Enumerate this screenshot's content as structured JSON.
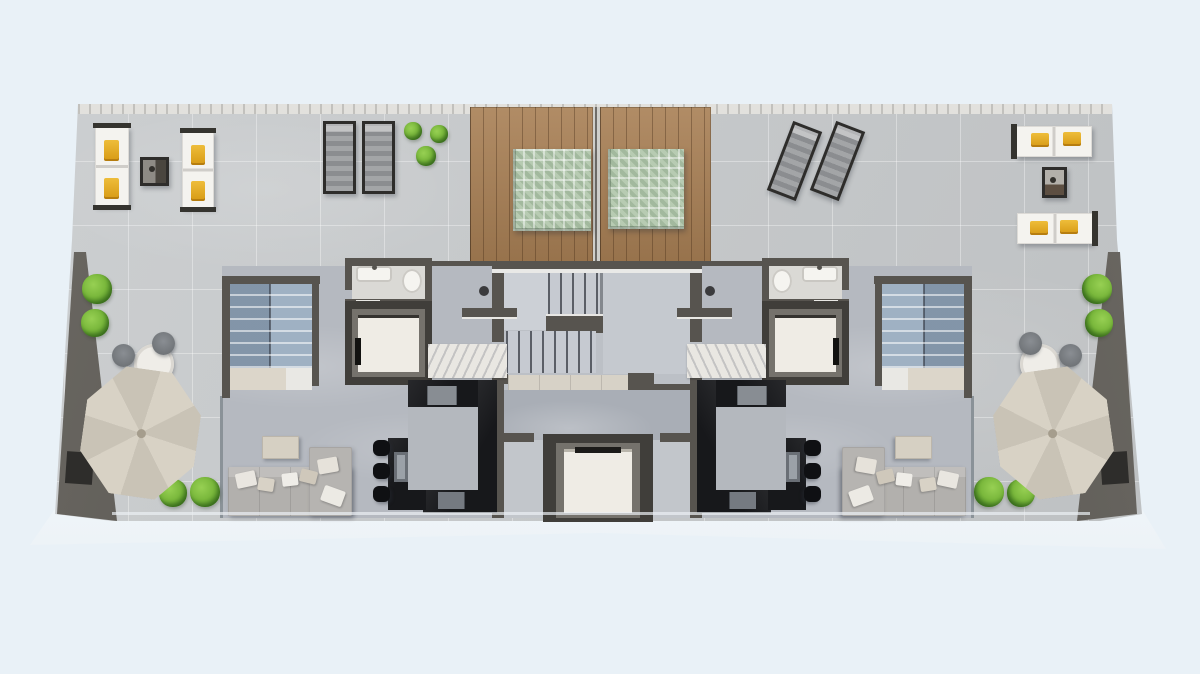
{
  "scene": {
    "type": "architectural-floor-plan",
    "view": "top-down-3d-render",
    "level": "roof-terrace-penthouse-level",
    "units": 2,
    "layout": "two mirrored apartments flanking a central communal stair and elevator core, wrap-around roof terrace"
  },
  "palette": {
    "bg": "#e9f1f7",
    "tile": "#c7cacc",
    "interior": "#b5b9c0",
    "core": "#bcc0c6",
    "hall": "#a9aeb6",
    "wall": "#57544f",
    "wallDark": "#3f3d3a",
    "wallLight": "#716e68",
    "wood": "#a87f54",
    "daybed": "#b7cbb2",
    "stair": "#9fb1c3",
    "landingBeige": "#dcd6ca",
    "kitchen": "#17181b",
    "appliance": "#888d93",
    "stool": "#0f1013",
    "sofa": "#b2b0ad",
    "pillowY": "#e0a41e",
    "pad": "#f4f3ef",
    "frame": "#2e2d2b",
    "slatA": "#a3a5a7",
    "slatB": "#8b8d90",
    "cab": "#efece5",
    "elevFrame": "#75726c",
    "elevSurround": "#403e3a",
    "rug": "#e9e7e2",
    "threshold": "#d7d2c7",
    "glassLine": "#8a9298",
    "parasolA": "#d8d2c5",
    "parasolB": "#c9c3b6",
    "plantA": "#7ab83c",
    "plantB": "#4c8a24",
    "tableBeige": "#d6d0c3",
    "chairGray": "#717579",
    "patioTable": "#efede8",
    "hatchA": "#c2c1bd",
    "hatchB": "#e2e1dd",
    "stairCoreBase": "#c6cad1",
    "stairCoreLine": "#5a5e66"
  },
  "plants": {
    "mirrored": [
      {
        "x": 97,
        "y": 289,
        "r": 15
      },
      {
        "x": 95,
        "y": 323,
        "r": 14
      },
      {
        "x": 173,
        "y": 493,
        "r": 14
      },
      {
        "x": 205,
        "y": 492,
        "r": 15
      }
    ],
    "top": [
      {
        "x": 413,
        "y": 131,
        "r": 9
      },
      {
        "x": 439,
        "y": 134,
        "r": 9
      },
      {
        "x": 426,
        "y": 156,
        "r": 10
      }
    ]
  },
  "inventory": [
    {
      "name": "wood-roof-deck-with-green-daybed",
      "count": 2
    },
    {
      "name": "double-sun-lounger-white-yellow-pillows",
      "count": 4
    },
    {
      "name": "slatted-sun-lounger-dark-frame",
      "count": 4
    },
    {
      "name": "outdoor-side-table",
      "count": 2
    },
    {
      "name": "cantilever-parasol-with-bistro-table-and-2-chairs",
      "count": 2
    },
    {
      "name": "private-switchback-staircase",
      "count": 2
    },
    {
      "name": "private-elevator",
      "count": 2
    },
    {
      "name": "bathroom-sink-toilet",
      "count": 2
    },
    {
      "name": "black-marble-u-kitchen-with-island-3-stools",
      "count": 2
    },
    {
      "name": "sofa-with-chaise-and-coffee-table",
      "count": 2
    },
    {
      "name": "communal-staircase",
      "count": 1
    },
    {
      "name": "communal-elevator",
      "count": 1
    },
    {
      "name": "marble-entry-rug",
      "count": 2
    },
    {
      "name": "planter-box",
      "count": 2
    },
    {
      "name": "shrub-plant",
      "count": 11
    }
  ]
}
